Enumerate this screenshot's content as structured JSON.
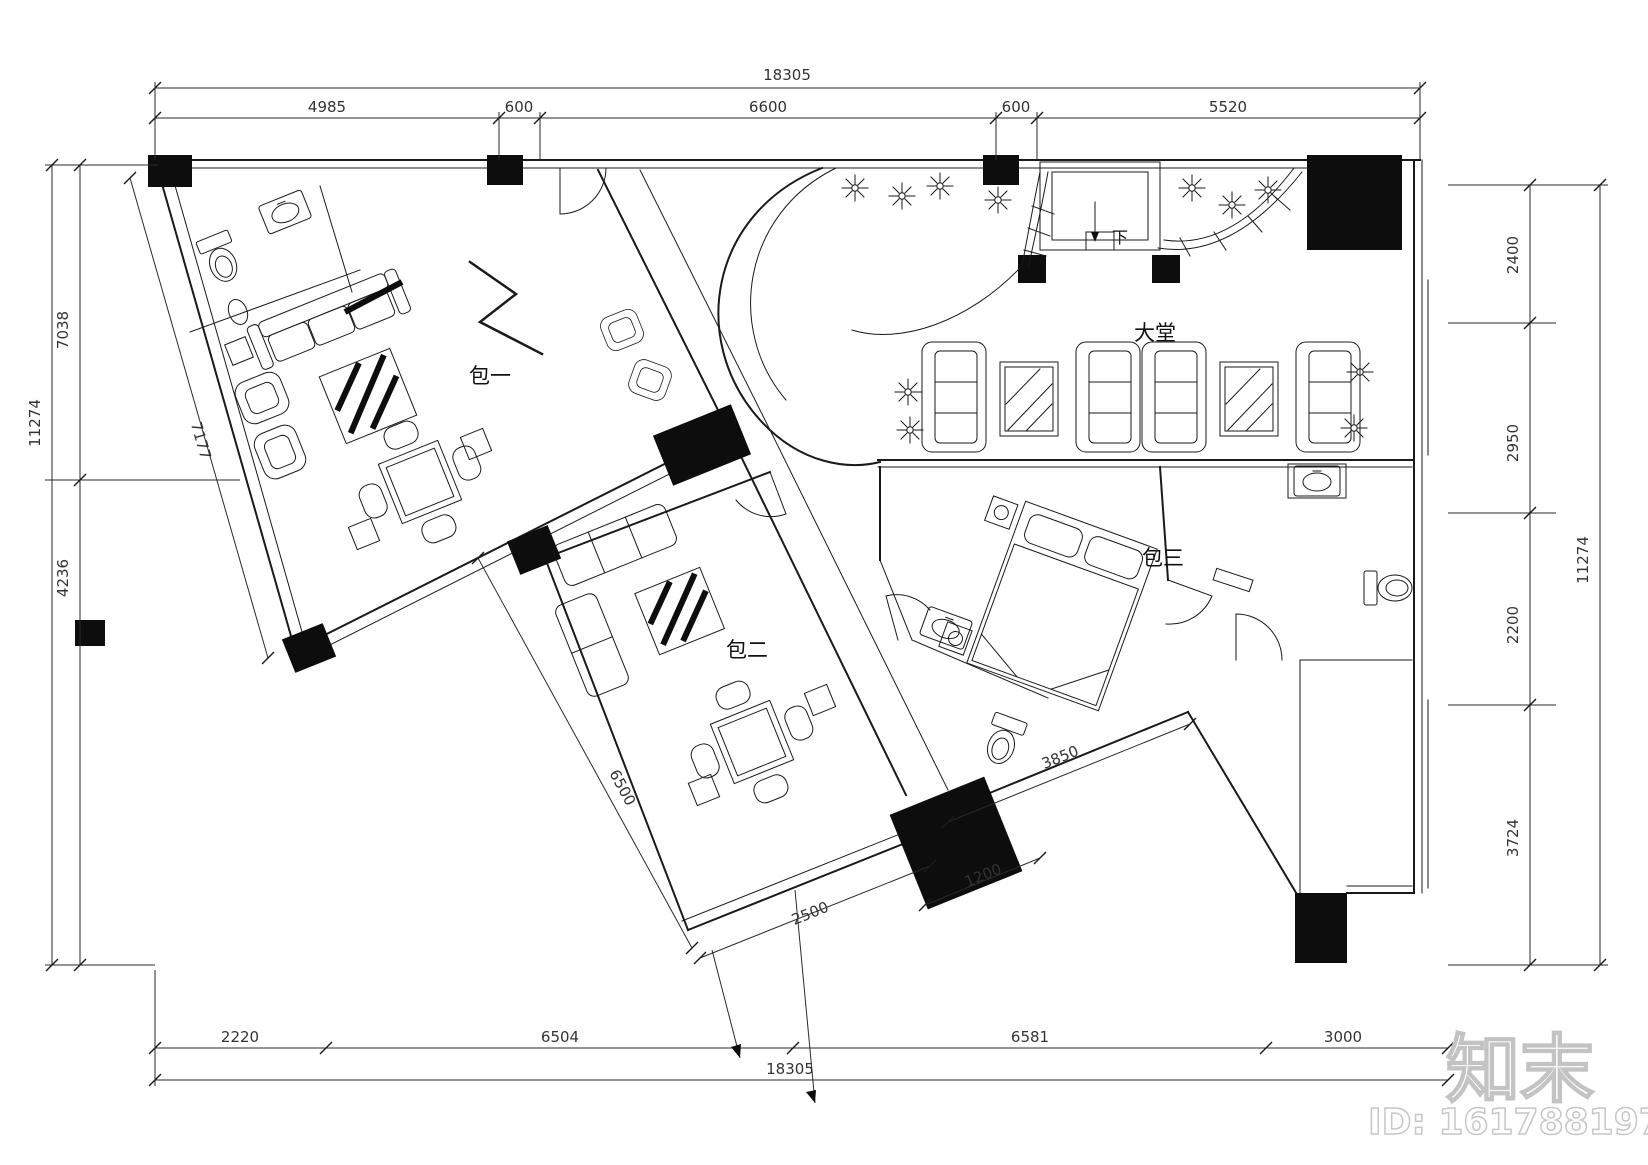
{
  "drawing": {
    "type": "ktv-club-floor-plan"
  },
  "rooms": {
    "room1": "包一",
    "room2": "包二",
    "room3": "包三",
    "lobby": "大堂",
    "elevator_down": "下"
  },
  "dimensions": {
    "top": {
      "overall": "18305",
      "segments": [
        "4985",
        "600",
        "6600",
        "600",
        "5520"
      ]
    },
    "bottom": {
      "overall": "18305",
      "segments": [
        "2220",
        "6504",
        "6581",
        "3000"
      ]
    },
    "left": {
      "overall": "11274",
      "segments": [
        "7038",
        "4236"
      ],
      "angled_wall": "7177"
    },
    "right": {
      "overall": "11274",
      "segments": [
        "2400",
        "2950",
        "2200",
        "3724"
      ]
    },
    "interior": {
      "room2_length": "6500",
      "room2_width": "2500",
      "corridor": "1200",
      "room3_wall": "3850"
    }
  },
  "watermark": {
    "logo": "知末",
    "id_label": "ID: 161788197"
  },
  "colors": {
    "ink": "#1a1a1a",
    "watermark_outline": "#c3c3c3",
    "background": "#ffffff"
  }
}
